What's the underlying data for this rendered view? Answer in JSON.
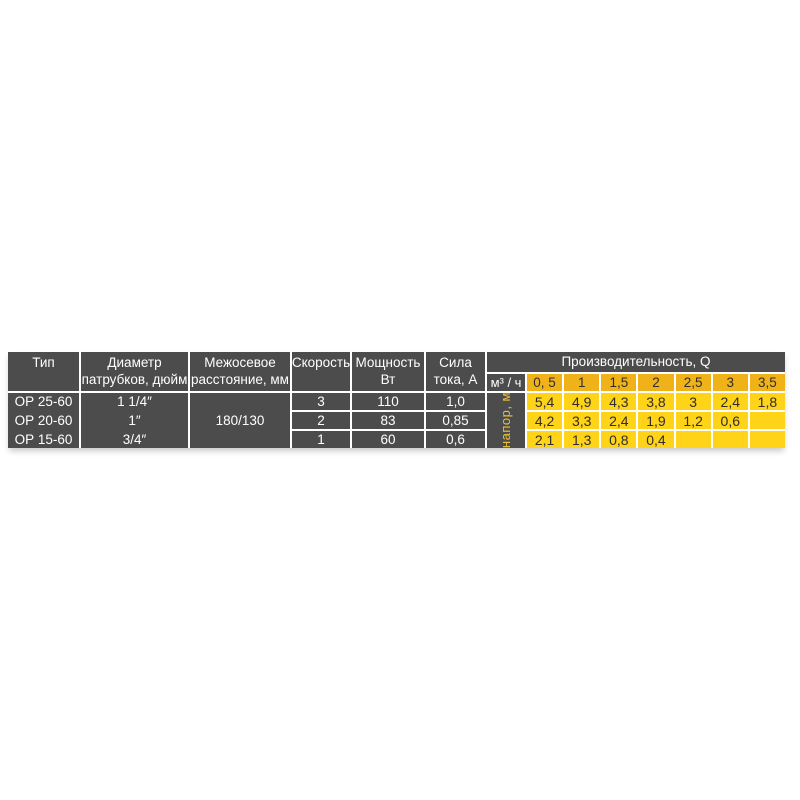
{
  "colors": {
    "cell_dark": "#4C4C4C",
    "header_yellow": "#F0B219",
    "data_yellow": "#FFD317",
    "head_label_text": "#F0C330",
    "text_light": "#FFFFFF",
    "text_dark": "#2E2E2E"
  },
  "table": {
    "header": {
      "type": "Тип",
      "diameter": [
        "Диаметр",
        "патрубков, дюйм"
      ],
      "axial": [
        "Межосевое",
        "расстояние, мм"
      ],
      "speed": "Скорость",
      "power": [
        "Мощность",
        "Вт"
      ],
      "current": [
        "Сила",
        "тока, А"
      ],
      "capacity": "Производительность, Q",
      "flow_unit": "м³ / ч",
      "head_unit": "напор, м",
      "flow_values": [
        "0, 5",
        "1",
        "1,5",
        "2",
        "2,5",
        "3",
        "3,5"
      ]
    },
    "axial_distance": "180/130",
    "rows": [
      {
        "type": "ОР 25-60",
        "diameter": "1 1/4″",
        "speed": "3",
        "power": "110",
        "current": "1,0",
        "heads": [
          "5,4",
          "4,9",
          "4,3",
          "3,8",
          "3",
          "2,4",
          "1,8"
        ]
      },
      {
        "type": "ОР 20-60",
        "diameter": "1″",
        "speed": "2",
        "power": "83",
        "current": "0,85",
        "heads": [
          "4,2",
          "3,3",
          "2,4",
          "1,9",
          "1,2",
          "0,6",
          ""
        ]
      },
      {
        "type": "ОР 15-60",
        "diameter": "3/4″",
        "speed": "1",
        "power": "60",
        "current": "0,6",
        "heads": [
          "2,1",
          "1,3",
          "0,8",
          "0,4",
          "",
          "",
          ""
        ]
      }
    ]
  }
}
